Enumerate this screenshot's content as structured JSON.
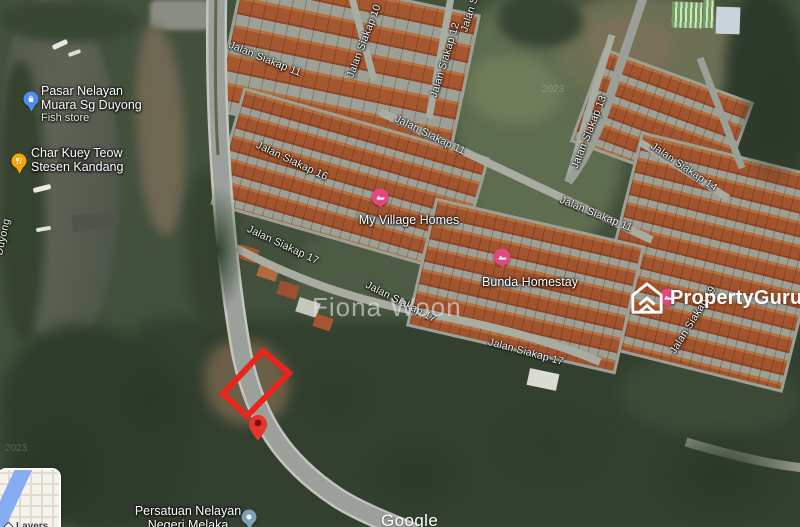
{
  "map_type": "satellite",
  "watermarks": {
    "agent": "Fiona Woon",
    "imagery_year": "2023"
  },
  "brand": {
    "logo_text": "PropertyGuru"
  },
  "attribution": {
    "logo": "Google"
  },
  "controls": {
    "layers": "Layers"
  },
  "street_labels": [
    {
      "text": "Jalan Siakap 11"
    },
    {
      "text": "Jalan Siakap 10"
    },
    {
      "text": "Jalan Si"
    },
    {
      "text": "Jalan Siakap 12"
    },
    {
      "text": "Jalan Siakap 13"
    },
    {
      "text": "Jalan Siakap 14"
    },
    {
      "text": "Jalan Siakap 16"
    },
    {
      "text": "Jalan Siakap 11"
    },
    {
      "text": "Jalan Siakap 11"
    },
    {
      "text": "Jalan Siakap 17"
    },
    {
      "text": "Jalan Siakap 17"
    },
    {
      "text": "Jalan Siakap 17"
    },
    {
      "text": "Jalan Siakap 19"
    },
    {
      "text": "Duyong"
    }
  ],
  "pois": [
    {
      "line1": "Pasar Nelayan",
      "line2": "Muara Sg Duyong",
      "subtitle": "Fish store",
      "icon": "shopping-pin",
      "color": "#4e8cf7"
    },
    {
      "line1": "Char Kuey Teow",
      "line2": "Stesen Kandang",
      "icon": "restaurant-pin",
      "color": "#f5a50a"
    },
    {
      "name": "My Village Homes",
      "icon": "lodging-pin",
      "color": "#e2487f"
    },
    {
      "name": "Bunda Homestay",
      "icon": "lodging-pin",
      "color": "#e2487f"
    },
    {
      "line1": "Persatuan Nelayan",
      "line2": "Negeri Melaka",
      "icon": "community-pin",
      "color": "#7fa1b8"
    },
    {
      "name": "",
      "icon": "lodging-pin",
      "color": "#e2487f"
    }
  ],
  "listing": {
    "boundary_color": "#e8261d",
    "marker_color": "#e5352c"
  }
}
